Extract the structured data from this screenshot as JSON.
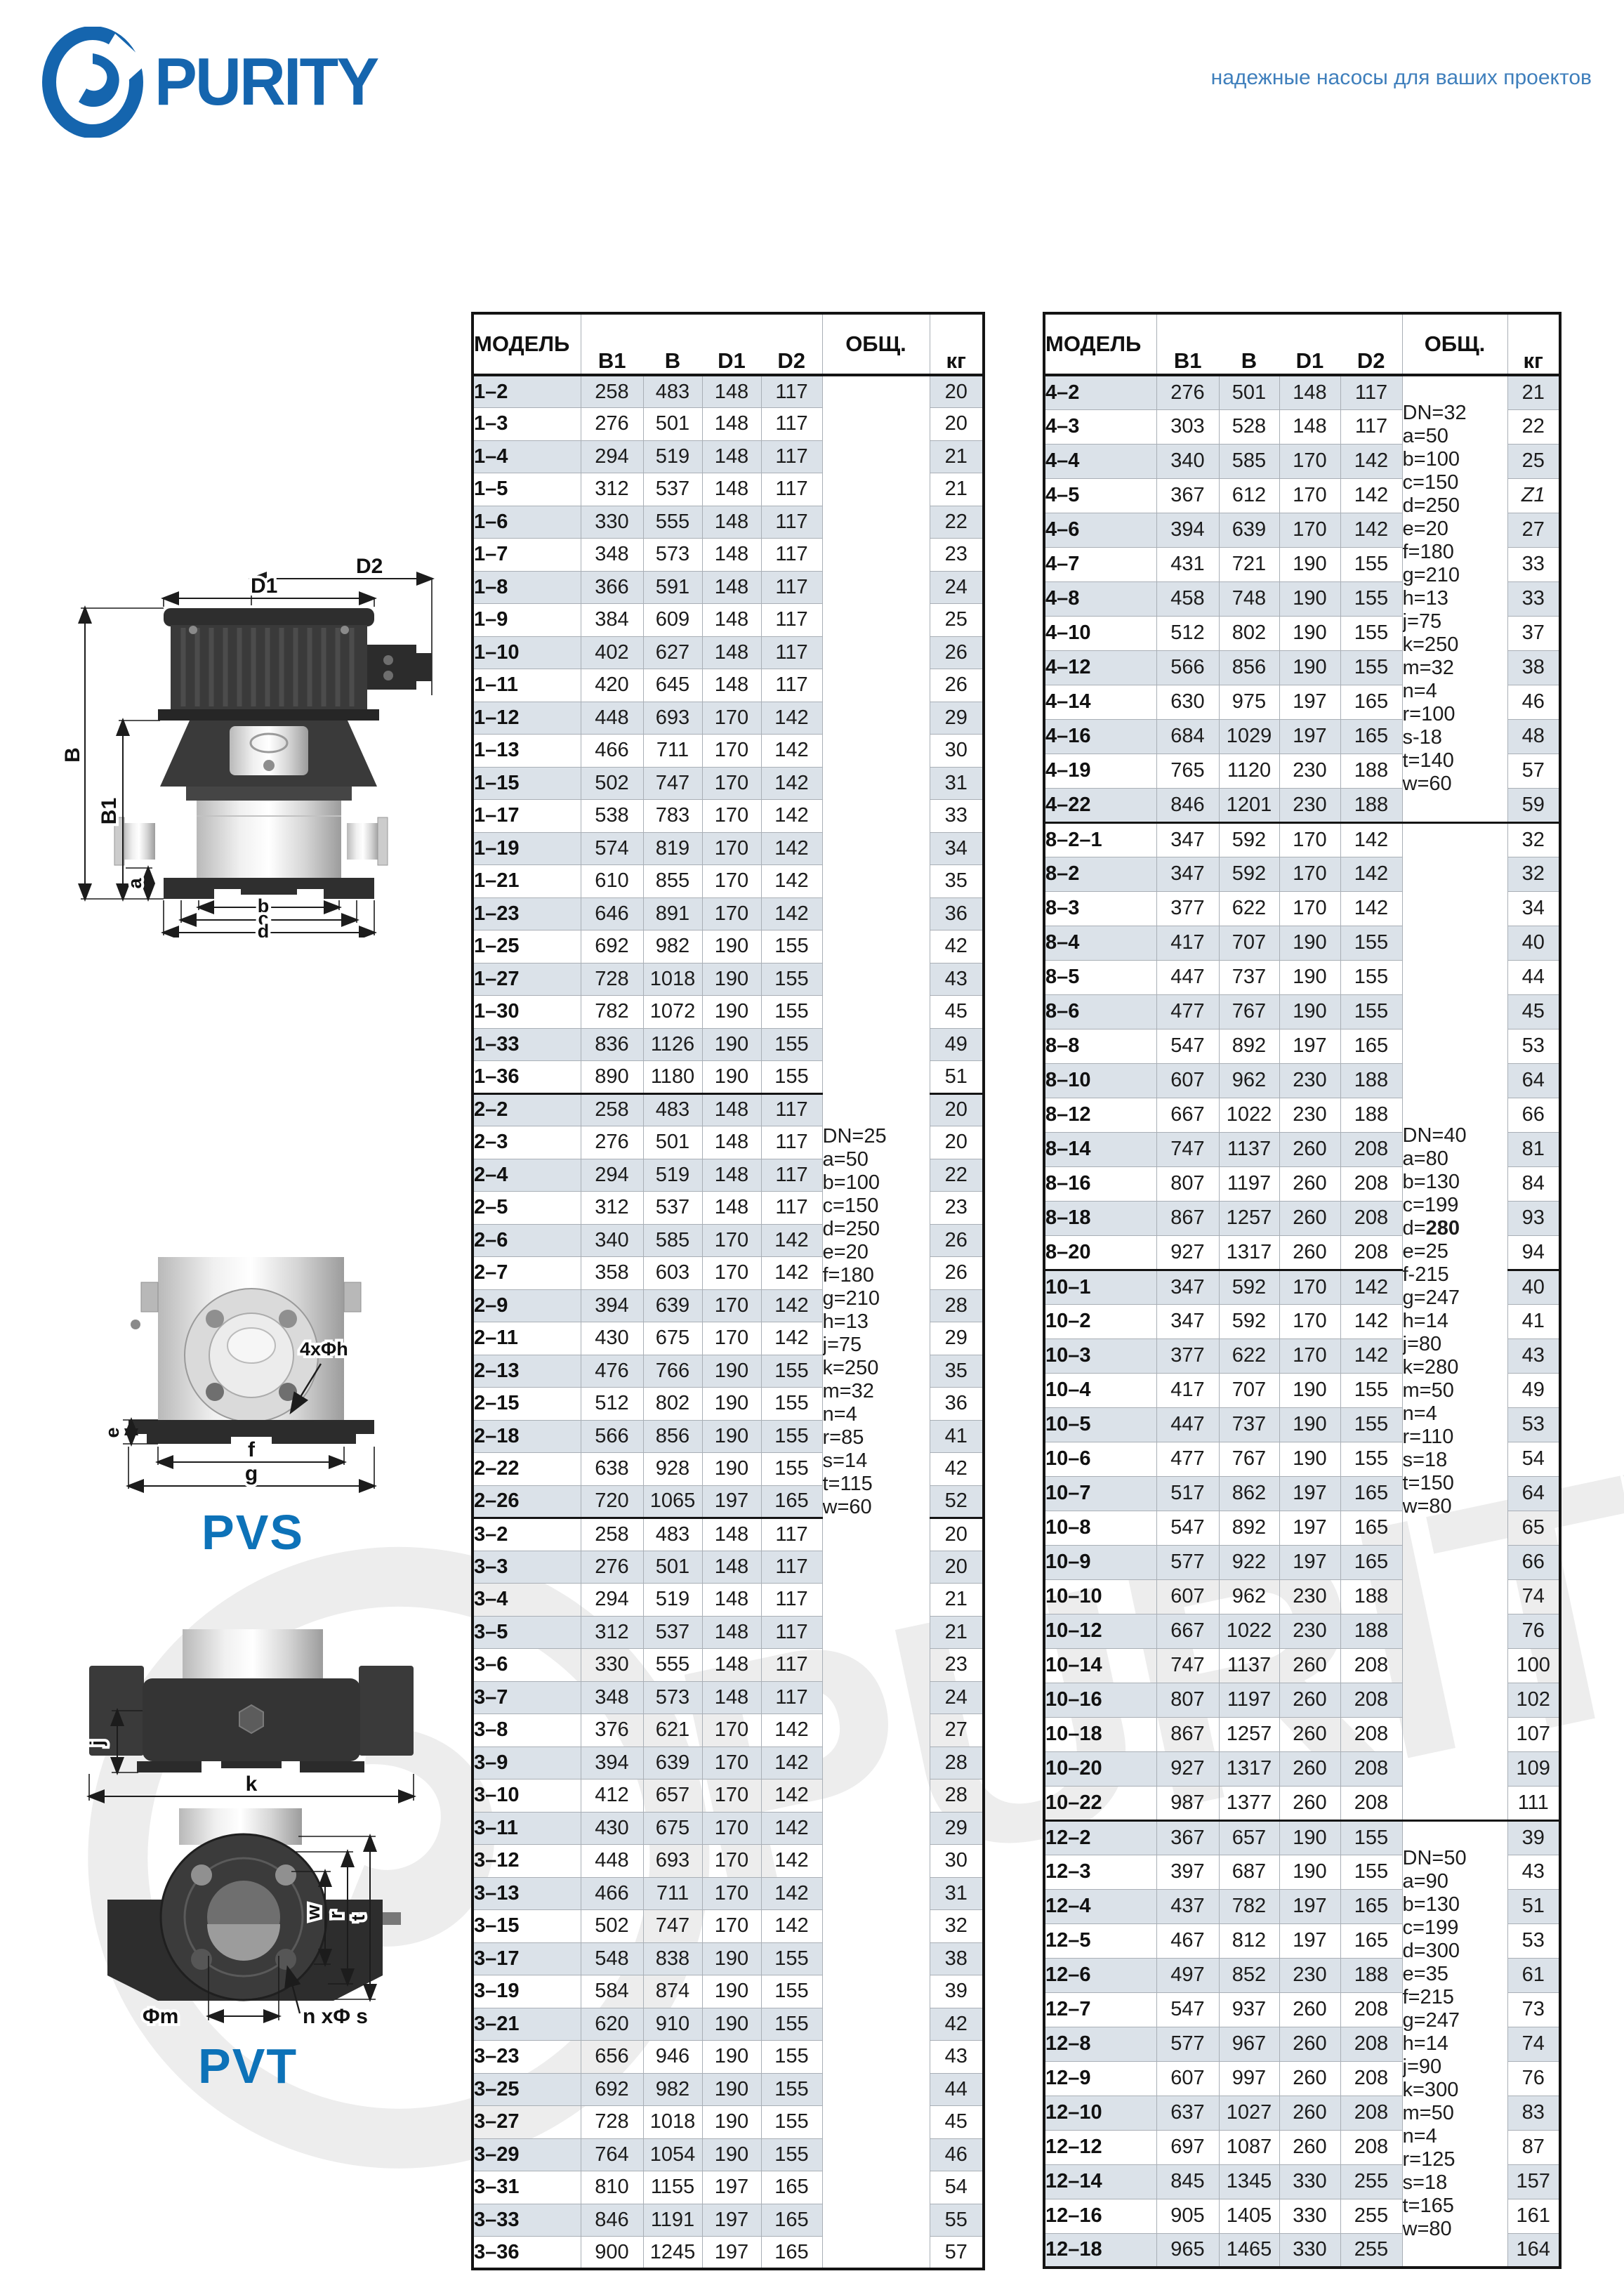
{
  "brand": {
    "accent_blue": "#1565ae",
    "caption_blue": "#0d72b8",
    "tagline_blue": "#3f7fbc",
    "row_shade": "#dbe2e9"
  },
  "logo": {
    "text": "PURITY"
  },
  "header": {
    "tagline": "надежные насосы для ваших проектов"
  },
  "watermark": {
    "text": "PURITY"
  },
  "drawings": {
    "pump_labels": {
      "d2": "D2",
      "d1": "D1",
      "b": "B",
      "b1": "B1",
      "a": "a",
      "bb": "b",
      "c": "c",
      "d": "d"
    },
    "pvs_labels": {
      "bolt": "4xΦh",
      "e": "e",
      "f": "f",
      "g": "g",
      "caption": "PVS"
    },
    "jk_labels": {
      "j": "j",
      "k": "k"
    },
    "pvt_labels": {
      "w": "w",
      "r": "r",
      "t": "t",
      "m": "Φm",
      "ns": "n xΦ s",
      "caption": "PVT"
    }
  },
  "table_left": {
    "headers": [
      "МОДЕЛЬ",
      "B1",
      "B",
      "D1",
      "D2",
      "ОБЩ.",
      "кг"
    ],
    "group_starts": [
      "2–2",
      "3–2"
    ],
    "obsh_blocks": [
      {
        "start": 0,
        "count": 58,
        "lines": [
          "DN=25",
          "a=50",
          "b=100",
          "c=150",
          "d=250",
          "e=20",
          "f=180",
          "g=210",
          "h=13",
          "j=75",
          "k=250",
          "m=32",
          "n=4",
          "r=85",
          "s=14",
          "t=115",
          "w=60"
        ]
      }
    ],
    "rows": [
      [
        "1–2",
        "258",
        "483",
        "148",
        "117",
        "20"
      ],
      [
        "1–3",
        "276",
        "501",
        "148",
        "117",
        "20"
      ],
      [
        "1–4",
        "294",
        "519",
        "148",
        "117",
        "21"
      ],
      [
        "1–5",
        "312",
        "537",
        "148",
        "117",
        "21"
      ],
      [
        "1–6",
        "330",
        "555",
        "148",
        "117",
        "22"
      ],
      [
        "1–7",
        "348",
        "573",
        "148",
        "117",
        "23"
      ],
      [
        "1–8",
        "366",
        "591",
        "148",
        "117",
        "24"
      ],
      [
        "1–9",
        "384",
        "609",
        "148",
        "117",
        "25"
      ],
      [
        "1–10",
        "402",
        "627",
        "148",
        "117",
        "26"
      ],
      [
        "1–11",
        "420",
        "645",
        "148",
        "117",
        "26"
      ],
      [
        "1–12",
        "448",
        "693",
        "170",
        "142",
        "29"
      ],
      [
        "1–13",
        "466",
        "711",
        "170",
        "142",
        "30"
      ],
      [
        "1–15",
        "502",
        "747",
        "170",
        "142",
        "31"
      ],
      [
        "1–17",
        "538",
        "783",
        "170",
        "142",
        "33"
      ],
      [
        "1–19",
        "574",
        "819",
        "170",
        "142",
        "34"
      ],
      [
        "1–21",
        "610",
        "855",
        "170",
        "142",
        "35"
      ],
      [
        "1–23",
        "646",
        "891",
        "170",
        "142",
        "36"
      ],
      [
        "1–25",
        "692",
        "982",
        "190",
        "155",
        "42"
      ],
      [
        "1–27",
        "728",
        "1018",
        "190",
        "155",
        "43"
      ],
      [
        "1–30",
        "782",
        "1072",
        "190",
        "155",
        "45"
      ],
      [
        "1–33",
        "836",
        "1126",
        "190",
        "155",
        "49"
      ],
      [
        "1–36",
        "890",
        "1180",
        "190",
        "155",
        "51"
      ],
      [
        "2–2",
        "258",
        "483",
        "148",
        "117",
        "20"
      ],
      [
        "2–3",
        "276",
        "501",
        "148",
        "117",
        "20"
      ],
      [
        "2–4",
        "294",
        "519",
        "148",
        "117",
        "22"
      ],
      [
        "2–5",
        "312",
        "537",
        "148",
        "117",
        "23"
      ],
      [
        "2–6",
        "340",
        "585",
        "170",
        "142",
        "26"
      ],
      [
        "2–7",
        "358",
        "603",
        "170",
        "142",
        "26"
      ],
      [
        "2–9",
        "394",
        "639",
        "170",
        "142",
        "28"
      ],
      [
        "2–11",
        "430",
        "675",
        "170",
        "142",
        "29"
      ],
      [
        "2–13",
        "476",
        "766",
        "190",
        "155",
        "35"
      ],
      [
        "2–15",
        "512",
        "802",
        "190",
        "155",
        "36"
      ],
      [
        "2–18",
        "566",
        "856",
        "190",
        "155",
        "41"
      ],
      [
        "2–22",
        "638",
        "928",
        "190",
        "155",
        "42"
      ],
      [
        "2–26",
        "720",
        "1065",
        "197",
        "165",
        "52"
      ],
      [
        "3–2",
        "258",
        "483",
        "148",
        "117",
        "20"
      ],
      [
        "3–3",
        "276",
        "501",
        "148",
        "117",
        "20"
      ],
      [
        "3–4",
        "294",
        "519",
        "148",
        "117",
        "21"
      ],
      [
        "3–5",
        "312",
        "537",
        "148",
        "117",
        "21"
      ],
      [
        "3–6",
        "330",
        "555",
        "148",
        "117",
        "23"
      ],
      [
        "3–7",
        "348",
        "573",
        "148",
        "117",
        "24"
      ],
      [
        "3–8",
        "376",
        "621",
        "170",
        "142",
        "27"
      ],
      [
        "3–9",
        "394",
        "639",
        "170",
        "142",
        "28"
      ],
      [
        "3–10",
        "412",
        "657",
        "170",
        "142",
        "28"
      ],
      [
        "3–11",
        "430",
        "675",
        "170",
        "142",
        "29"
      ],
      [
        "3–12",
        "448",
        "693",
        "170",
        "142",
        "30"
      ],
      [
        "3–13",
        "466",
        "711",
        "170",
        "142",
        "31"
      ],
      [
        "3–15",
        "502",
        "747",
        "170",
        "142",
        "32"
      ],
      [
        "3–17",
        "548",
        "838",
        "190",
        "155",
        "38"
      ],
      [
        "3–19",
        "584",
        "874",
        "190",
        "155",
        "39"
      ],
      [
        "3–21",
        "620",
        "910",
        "190",
        "155",
        "42"
      ],
      [
        "3–23",
        "656",
        "946",
        "190",
        "155",
        "43"
      ],
      [
        "3–25",
        "692",
        "982",
        "190",
        "155",
        "44"
      ],
      [
        "3–27",
        "728",
        "1018",
        "190",
        "155",
        "45"
      ],
      [
        "3–29",
        "764",
        "1054",
        "190",
        "155",
        "46"
      ],
      [
        "3–31",
        "810",
        "1155",
        "197",
        "165",
        "54"
      ],
      [
        "3–33",
        "846",
        "1191",
        "197",
        "165",
        "55"
      ],
      [
        "3–36",
        "900",
        "1245",
        "197",
        "165",
        "57"
      ]
    ]
  },
  "table_right": {
    "headers": [
      "МОДЕЛЬ",
      "B1",
      "B",
      "D1",
      "D2",
      "ОБЩ.",
      "кг"
    ],
    "group_starts": [
      "8–2–1",
      "10–1",
      "12–2"
    ],
    "obsh_blocks": [
      {
        "start": 0,
        "count": 13,
        "lines": [
          "DN=32",
          "a=50",
          "b=100",
          "c=150",
          "d=250",
          "e=20",
          "f=180",
          "g=210",
          "h=13",
          "j=75",
          "k=250",
          "m=32",
          "n=4",
          "r=100",
          "s-18",
          "t=140",
          "w=60"
        ]
      },
      {
        "start": 13,
        "count": 29,
        "lines": [
          "DN=40",
          "a=80",
          "b=130",
          "c=199",
          "d=**280**",
          "e=25",
          "f-215",
          "g=247",
          "h=14",
          "j=80",
          "k=280",
          "m=50",
          "n=4",
          "r=110",
          "s=18",
          "t=150",
          "w=80"
        ]
      },
      {
        "start": 42,
        "count": 13,
        "lines": [
          "DN=50",
          "a=90",
          "b=130",
          "c=199",
          "d=300",
          "e=35",
          "f=215",
          "g=247",
          "h=14",
          "j=90",
          "k=300",
          "m=50",
          "n=4",
          "r=125",
          "s=18",
          "t=165",
          "w=80"
        ]
      }
    ],
    "rows": [
      [
        "4–2",
        "276",
        "501",
        "148",
        "117",
        "21"
      ],
      [
        "4–3",
        "303",
        "528",
        "148",
        "117",
        "22"
      ],
      [
        "4–4",
        "340",
        "585",
        "170",
        "142",
        "25"
      ],
      [
        "4–5",
        "367",
        "612",
        "170",
        "142",
        "Z1"
      ],
      [
        "4–6",
        "394",
        "639",
        "170",
        "142",
        "27"
      ],
      [
        "4–7",
        "431",
        "721",
        "190",
        "155",
        "33"
      ],
      [
        "4–8",
        "458",
        "748",
        "190",
        "155",
        "33"
      ],
      [
        "4–10",
        "512",
        "802",
        "190",
        "155",
        "37"
      ],
      [
        "4–12",
        "566",
        "856",
        "190",
        "155",
        "38"
      ],
      [
        "4–14",
        "630",
        "975",
        "197",
        "165",
        "46"
      ],
      [
        "4–16",
        "684",
        "1029",
        "197",
        "165",
        "48"
      ],
      [
        "4–19",
        "765",
        "1120",
        "230",
        "188",
        "57"
      ],
      [
        "4–22",
        "846",
        "1201",
        "230",
        "188",
        "59"
      ],
      [
        "8–2–1",
        "347",
        "592",
        "170",
        "142",
        "32"
      ],
      [
        "8–2",
        "347",
        "592",
        "170",
        "142",
        "32"
      ],
      [
        "8–3",
        "377",
        "622",
        "170",
        "142",
        "34"
      ],
      [
        "8–4",
        "417",
        "707",
        "190",
        "155",
        "40"
      ],
      [
        "8–5",
        "447",
        "737",
        "190",
        "155",
        "44"
      ],
      [
        "8–6",
        "477",
        "767",
        "190",
        "155",
        "45"
      ],
      [
        "8–8",
        "547",
        "892",
        "197",
        "165",
        "53"
      ],
      [
        "8–10",
        "607",
        "962",
        "230",
        "188",
        "64"
      ],
      [
        "8–12",
        "667",
        "1022",
        "230",
        "188",
        "66"
      ],
      [
        "8–14",
        "747",
        "1137",
        "260",
        "208",
        "81"
      ],
      [
        "8–16",
        "807",
        "1197",
        "260",
        "208",
        "84"
      ],
      [
        "8–18",
        "867",
        "1257",
        "260",
        "208",
        "93"
      ],
      [
        "8–20",
        "927",
        "1317",
        "260",
        "208",
        "94"
      ],
      [
        "10–1",
        "347",
        "592",
        "170",
        "142",
        "40"
      ],
      [
        "10–2",
        "347",
        "592",
        "170",
        "142",
        "41"
      ],
      [
        "10–3",
        "377",
        "622",
        "170",
        "142",
        "43"
      ],
      [
        "10–4",
        "417",
        "707",
        "190",
        "155",
        "49"
      ],
      [
        "10–5",
        "447",
        "737",
        "190",
        "155",
        "53"
      ],
      [
        "10–6",
        "477",
        "767",
        "190",
        "155",
        "54"
      ],
      [
        "10–7",
        "517",
        "862",
        "197",
        "165",
        "64"
      ],
      [
        "10–8",
        "547",
        "892",
        "197",
        "165",
        "65"
      ],
      [
        "10–9",
        "577",
        "922",
        "197",
        "165",
        "66"
      ],
      [
        "10–10",
        "607",
        "962",
        "230",
        "188",
        "74"
      ],
      [
        "10–12",
        "667",
        "1022",
        "230",
        "188",
        "76"
      ],
      [
        "10–14",
        "747",
        "1137",
        "260",
        "208",
        "100"
      ],
      [
        "10–16",
        "807",
        "1197",
        "260",
        "208",
        "102"
      ],
      [
        "10–18",
        "867",
        "1257",
        "260",
        "208",
        "107"
      ],
      [
        "10–20",
        "927",
        "1317",
        "260",
        "208",
        "109"
      ],
      [
        "10–22",
        "987",
        "1377",
        "260",
        "208",
        "111"
      ],
      [
        "12–2",
        "367",
        "657",
        "190",
        "155",
        "39"
      ],
      [
        "12–3",
        "397",
        "687",
        "190",
        "155",
        "43"
      ],
      [
        "12–4",
        "437",
        "782",
        "197",
        "165",
        "51"
      ],
      [
        "12–5",
        "467",
        "812",
        "197",
        "165",
        "53"
      ],
      [
        "12–6",
        "497",
        "852",
        "230",
        "188",
        "61"
      ],
      [
        "12–7",
        "547",
        "937",
        "260",
        "208",
        "73"
      ],
      [
        "12–8",
        "577",
        "967",
        "260",
        "208",
        "74"
      ],
      [
        "12–9",
        "607",
        "997",
        "260",
        "208",
        "76"
      ],
      [
        "12–10",
        "637",
        "1027",
        "260",
        "208",
        "83"
      ],
      [
        "12–12",
        "697",
        "1087",
        "260",
        "208",
        "87"
      ],
      [
        "12–14",
        "845",
        "1345",
        "330",
        "255",
        "157"
      ],
      [
        "12–16",
        "905",
        "1405",
        "330",
        "255",
        "161"
      ],
      [
        "12–18",
        "965",
        "1465",
        "330",
        "255",
        "164"
      ]
    ]
  }
}
